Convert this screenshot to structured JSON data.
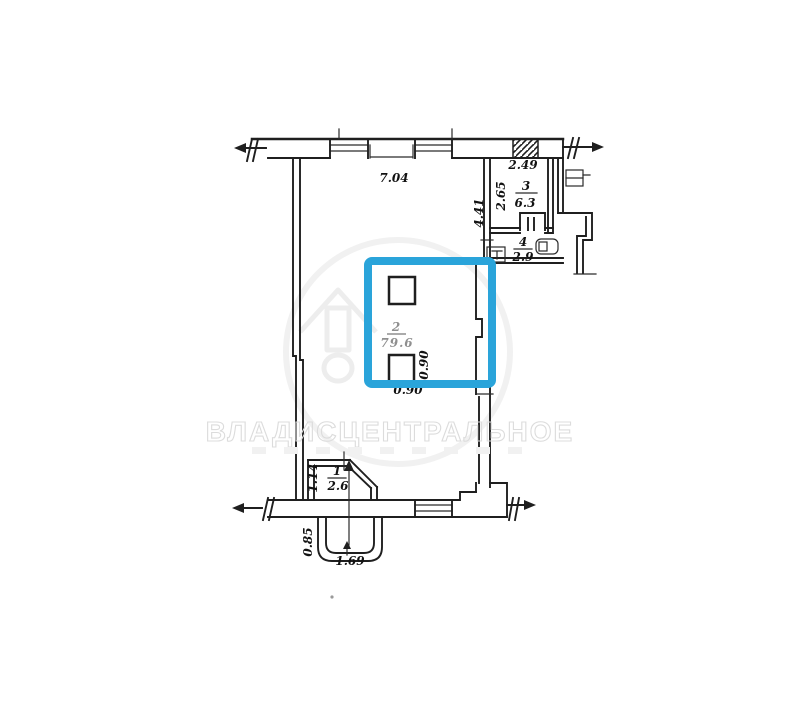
{
  "plan": {
    "title": "apartment-floor-plan-scan",
    "watermark_text": "ВЛАДИСЦЕНТРАЛЬНОЕ",
    "highlight_color": "#2aa4da",
    "line_color": "#1f1f1f",
    "rooms": [
      {
        "number": "1",
        "area": "2.6"
      },
      {
        "number": "2",
        "area": "79.6"
      },
      {
        "number": "3",
        "area": "6.3"
      },
      {
        "number": "4",
        "area": "2.9"
      }
    ],
    "dimensions": {
      "top_wall_width": "7.04",
      "room3_width": "2.49",
      "room3_depth": "2.65",
      "right_wall_depth": "4.41",
      "column_width_vertical": "0.90",
      "column_width_horizontal": "0.90",
      "room1_depth": "1.14",
      "porch_depth": "0.85",
      "porch_width": "1.69"
    }
  }
}
